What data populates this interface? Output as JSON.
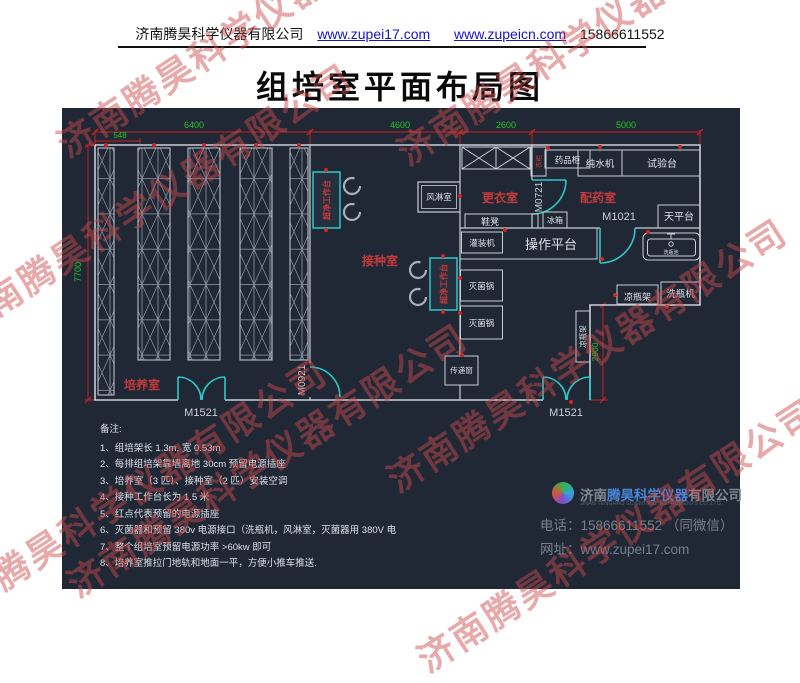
{
  "header": {
    "company": "济南腾昊科学仪器有限公司",
    "url1": "www.zupei17.com",
    "url2": "www.zupeicn.com",
    "phone": "15866611552"
  },
  "title": "组培室平面布局图",
  "watermark": "济南腾昊科学仪器有限公司",
  "plan": {
    "dims": {
      "d6400": "6400",
      "d4600": "4600",
      "d2600": "2600",
      "d5000": "5000",
      "d548": "548",
      "d7700": "7700",
      "d2900": "2900"
    },
    "rooms": {
      "culture": "培养室",
      "inoculation": "接种室",
      "changing": "更衣室",
      "dispensing": "配药室"
    },
    "doors": {
      "m1521": "M1521",
      "m0921": "M0921",
      "m0721": "M0721",
      "m1021": "M1021"
    },
    "equipment": {
      "air_shower": "风淋室",
      "clean_bench": "超净工作台",
      "wardrobe": "衣柜",
      "medicine_cabinet": "药品柜",
      "water_machine": "纯水机",
      "test_bench": "试验台",
      "balance": "天平台",
      "shoe_bench": "鞋凳",
      "fridge": "冰箱",
      "filling_machine": "灌装机",
      "platform": "操作平台",
      "sink": "洗瓶池",
      "sterilizer": "灭菌锅",
      "pass_window": "传递窗",
      "bottle_rack": "凉瓶架",
      "bottle_washer": "洗瓶机"
    }
  },
  "notes": {
    "heading": "备注:",
    "items": [
      "1、组培架长 1.3m, 宽 0.53m",
      "2、每排组培架靠墙离地 30cm 预留电源插座",
      "3、培养室（3 匹）、接种室（2 匹）安装空调",
      "4、接种工作台长为 1.5 米",
      "5、红点代表预留的电源插座",
      "6、灭菌器和预留 380v 电源接口（洗瓶机，风淋室，灭菌器用 380V 电",
      "7、整个组培室预留电源功率 >60kw 即可",
      "8、培养室推拉门地轨和地面一平，方便小推车推送."
    ]
  },
  "footer": {
    "company_prefix": "济南",
    "company_brand": "腾昊科学仪器",
    "company_suffix": "有限公司",
    "company_en": "JINAN TENGHAO SCIENTIFIC INSTRUMENTS CO.,LTD.",
    "phone_label": "电话：",
    "phone": "15866611552 （同微信）",
    "url_label": "网址：",
    "url": "www.zupei17.com"
  },
  "colors": {
    "accent_red": "#c43a3a",
    "dim_green": "#27c427",
    "door_cyan": "#2ec8c8",
    "brand_blue": "#4a86d8"
  }
}
